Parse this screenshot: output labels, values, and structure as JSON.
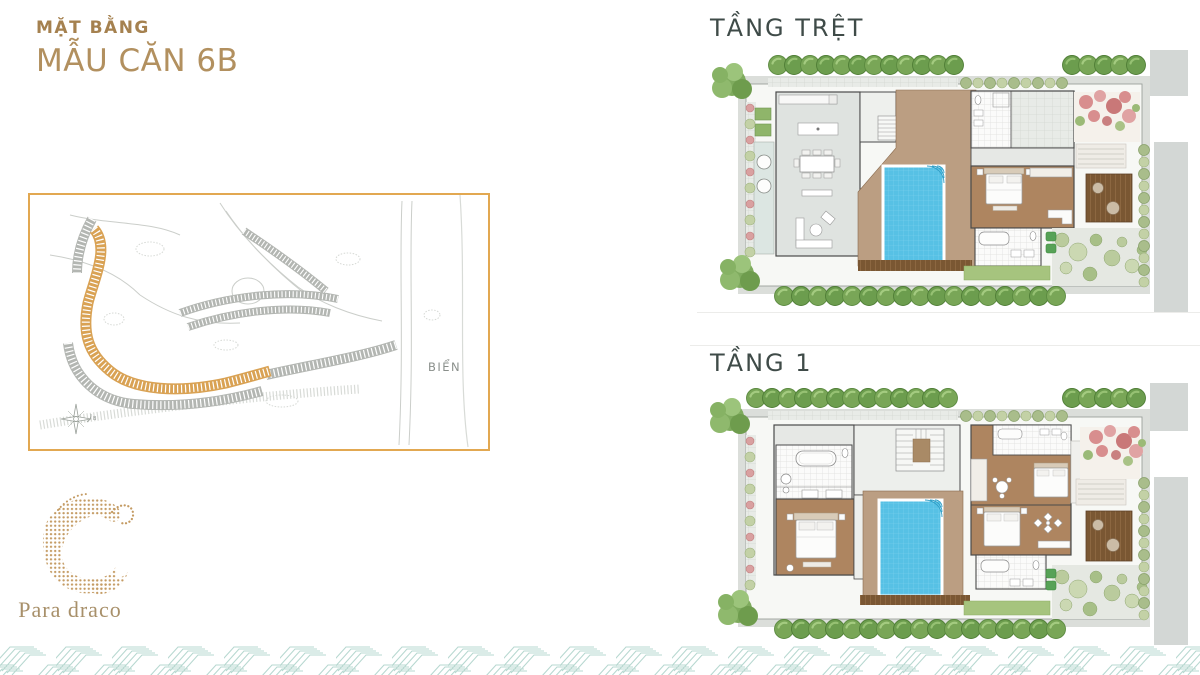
{
  "header": {
    "subtitle": "MẶT BẰNG",
    "title": "MẪU CĂN 6B"
  },
  "site_map": {
    "sea_label": "BIỂN",
    "compass_label": "B"
  },
  "floor_plans": [
    {
      "label": "TẦNG TRỆT"
    },
    {
      "label": "TẦNG 1"
    }
  ],
  "brand": {
    "name": "Para draco"
  },
  "palette": {
    "title_gold": "#A5814F",
    "accent_gold": "#B2905F",
    "map_border": "#E2A851",
    "lot_highlight": "#D9A254",
    "label_dark": "#3F4B48",
    "pool_blue": "#57C1E5",
    "deck_tan": "#BB9E82",
    "bedroom_brown": "#AE8560",
    "wood_deck": "#7A5733",
    "wave_teal": "#A5CEC5",
    "logo_gold": "#C49B63"
  }
}
